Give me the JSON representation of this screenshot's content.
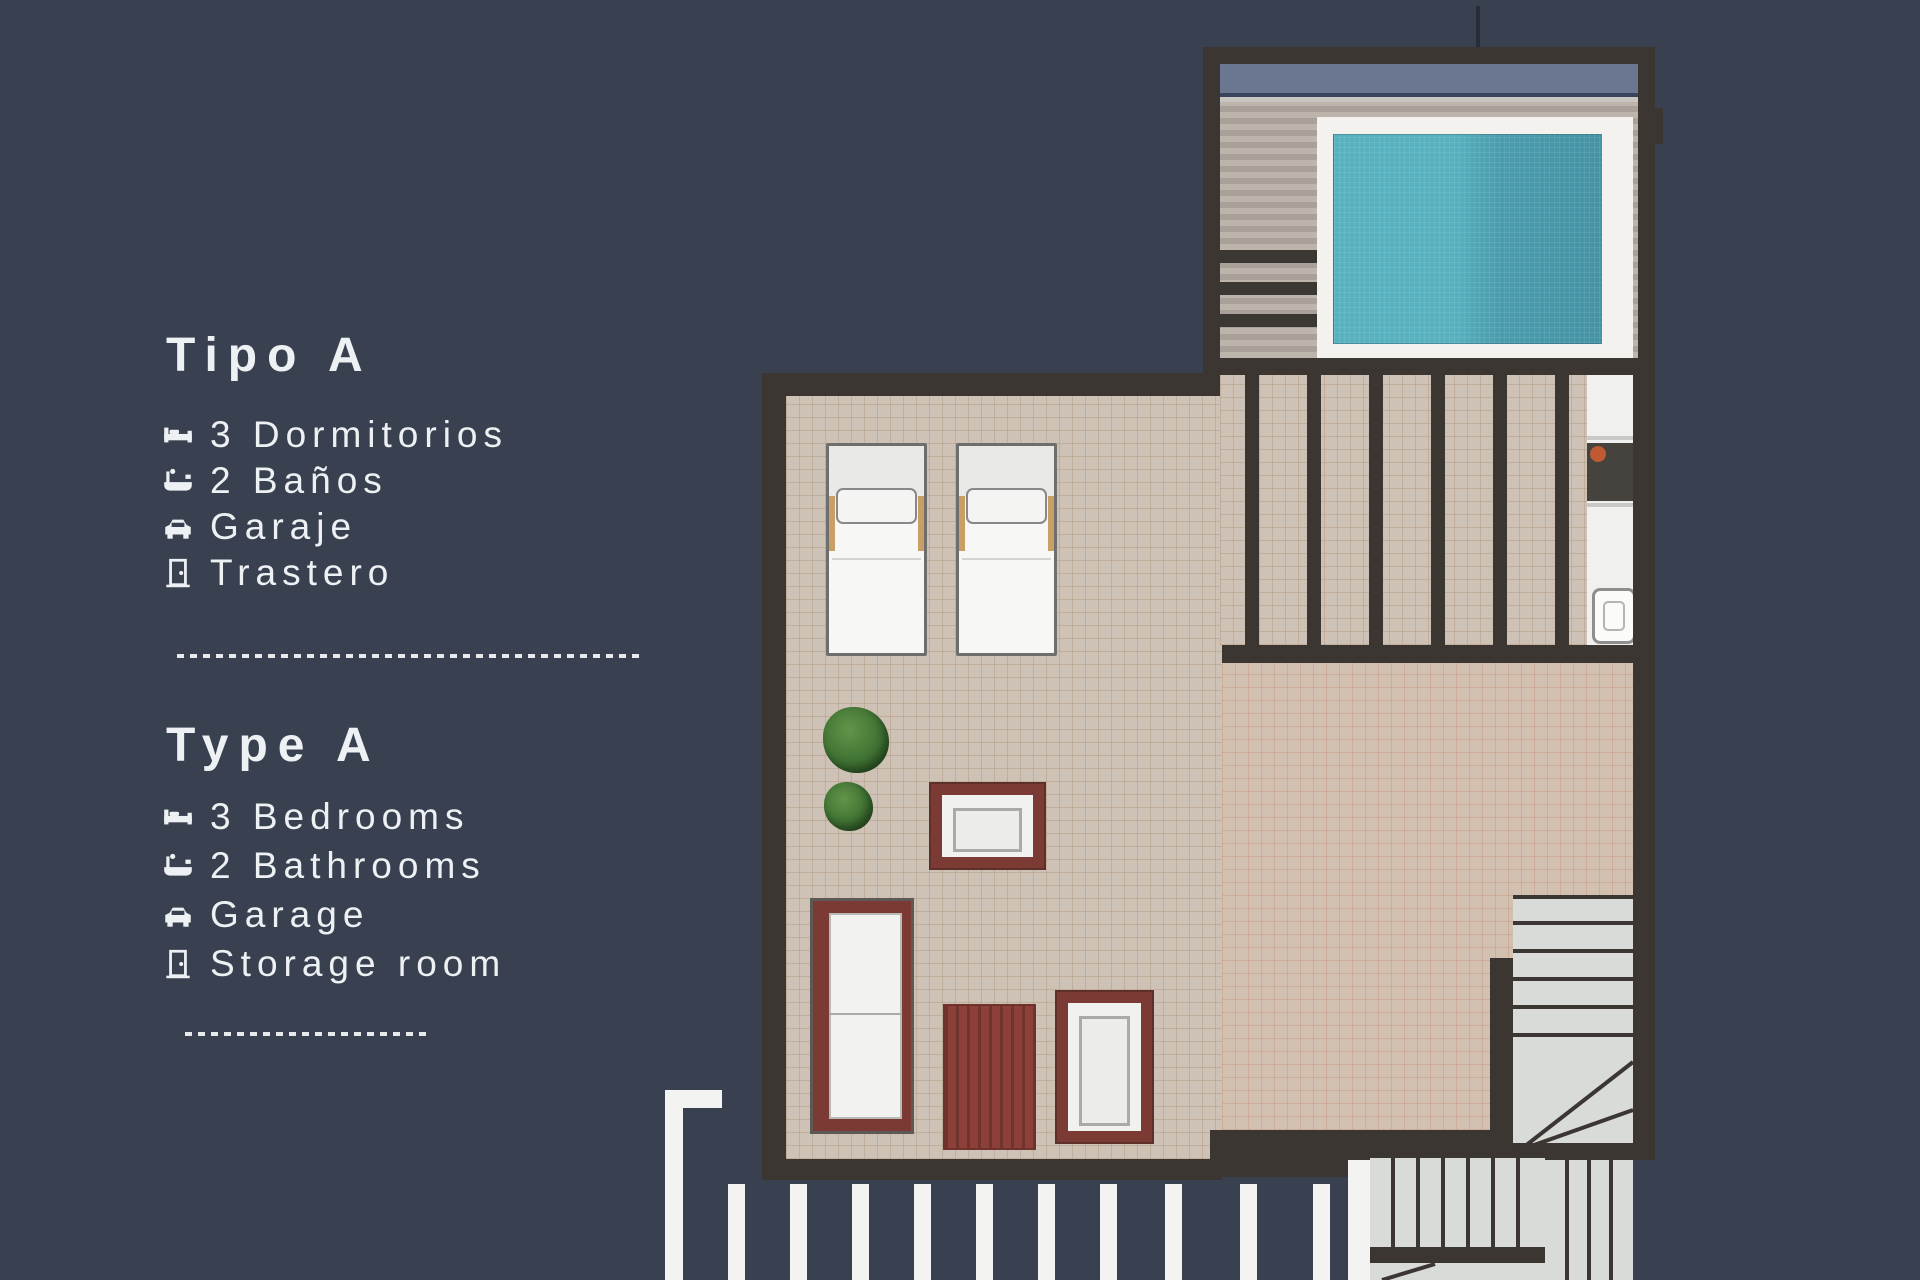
{
  "panel": {
    "sections": [
      {
        "title": "Tipo A",
        "items": [
          {
            "icon": "bed-icon",
            "label": "3 Dormitorios"
          },
          {
            "icon": "bath-icon",
            "label": "2 Baños"
          },
          {
            "icon": "car-icon",
            "label": "Garaje"
          },
          {
            "icon": "door-icon",
            "label": "Trastero"
          }
        ]
      },
      {
        "title": "Type A",
        "items": [
          {
            "icon": "bed-icon",
            "label": "3 Bedrooms"
          },
          {
            "icon": "bath-icon",
            "label": "2 Bathrooms"
          },
          {
            "icon": "car-icon",
            "label": "Garage"
          },
          {
            "icon": "door-icon",
            "label": "Storage room"
          }
        ]
      }
    ]
  },
  "floorplan": {
    "elements": [
      "swimming-pool",
      "pool-deck",
      "roof-terrace",
      "sun-loungers",
      "potted-plants",
      "outdoor-sofa",
      "rug",
      "armchair",
      "coffee-table",
      "pergola-slats",
      "kitchenette-counter",
      "cooktop",
      "sink",
      "upper-staircase",
      "lower-staircase",
      "railing-beams"
    ],
    "colors": {
      "background": "#394050",
      "wall": "#3b3631",
      "terrace_floor": "#cdc2b5",
      "pool_water": "#55aebb",
      "pool_apron": "#f3f2ef",
      "furniture_maroon": "#7b3b34",
      "plant_green": "#3f7233",
      "stairs_gray": "#d9dbd9",
      "text": "#eef1f4"
    }
  }
}
